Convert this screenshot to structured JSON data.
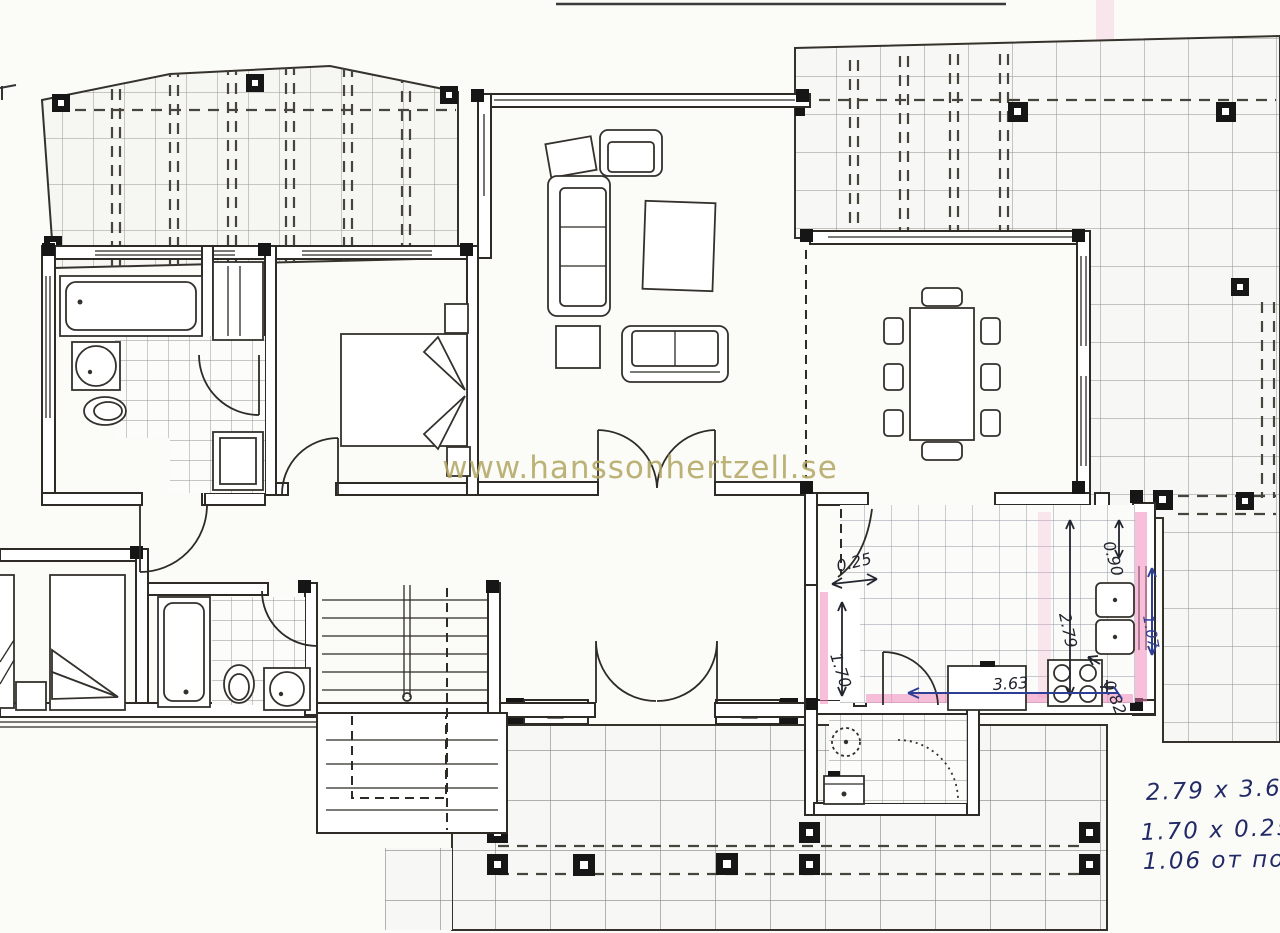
{
  "document": {
    "kind": "scanned hand-annotated villa floor plan"
  },
  "watermark": {
    "text": "www.hanssonhertzell.se",
    "color": "#b4a967"
  },
  "plan_dimensions": {
    "niche_width": "0.25",
    "pantry_depth": "1.70",
    "kitchen_length": "2.79",
    "terrace_pass": "0.90",
    "walkway_width": "1.07",
    "counter_gap": "0.82",
    "kitchen_width": "3.63"
  },
  "handwritten_notes": {
    "line1": "2.79 x 3.63",
    "line2": "1.70 x 0.25 М",
    "line3": "1.06 от пола"
  },
  "colors": {
    "highlight_pink": "#f07fb5",
    "ink_blue": "#2f3e95",
    "ink_dark": "#23252e",
    "watermark_gold": "#b4a967",
    "wall_line": "#2e2b26"
  }
}
